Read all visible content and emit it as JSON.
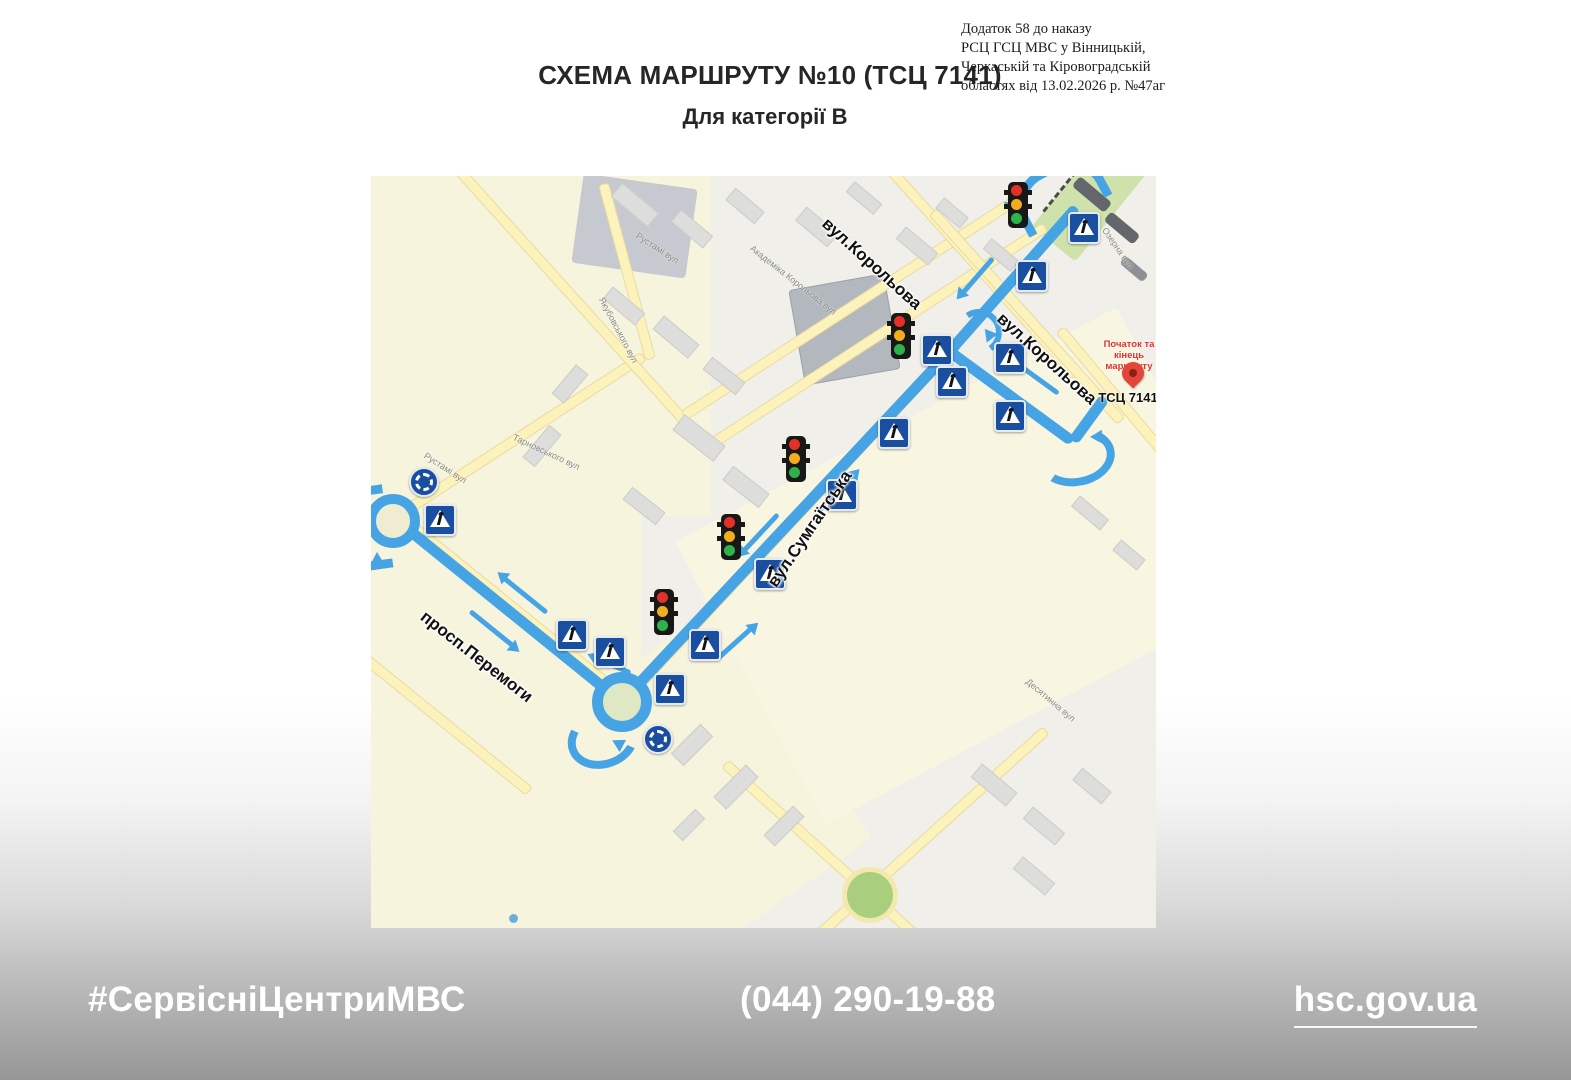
{
  "header": {
    "title": "СХЕМА МАРШРУТУ №10 (ТСЦ 7141)",
    "subtitle": "Для категорії В",
    "annotation_lines": [
      "Додаток 58 до наказу",
      "РСЦ ГСЦ МВС у Вінницькій,",
      "Черкаській та Кіровоградській",
      "областях від 13.02.2026 р. №47аг"
    ]
  },
  "map": {
    "street_labels": {
      "korolova_top": "вул.Корольова",
      "korolova_right": "вул.Корольова",
      "sumhaitska": "вул.Сумгаїтська",
      "peremohy": "просп.Перемоги"
    },
    "minor_street_labels": [
      "Рустамі вул",
      "Якубовського вул",
      "Академіка Корольова вул",
      "Озерна вул",
      "Десятинна вул",
      "Тарновського вул",
      "Рустамі вул"
    ],
    "destination": {
      "start_end_label": "Початок та кінець маршруту",
      "name": "ТСЦ 7141"
    },
    "colors": {
      "route_blue": "#47a4e4",
      "sign_blue": "#1a4fa0",
      "pin_red": "#e2453a",
      "map_cream": "#f7f4de",
      "map_green": "#cfe2ab"
    }
  },
  "footer": {
    "hashtag": "#СервісніЦентриМВС",
    "phone": "(044) 290-19-88",
    "website": "hsc.gov.ua"
  }
}
